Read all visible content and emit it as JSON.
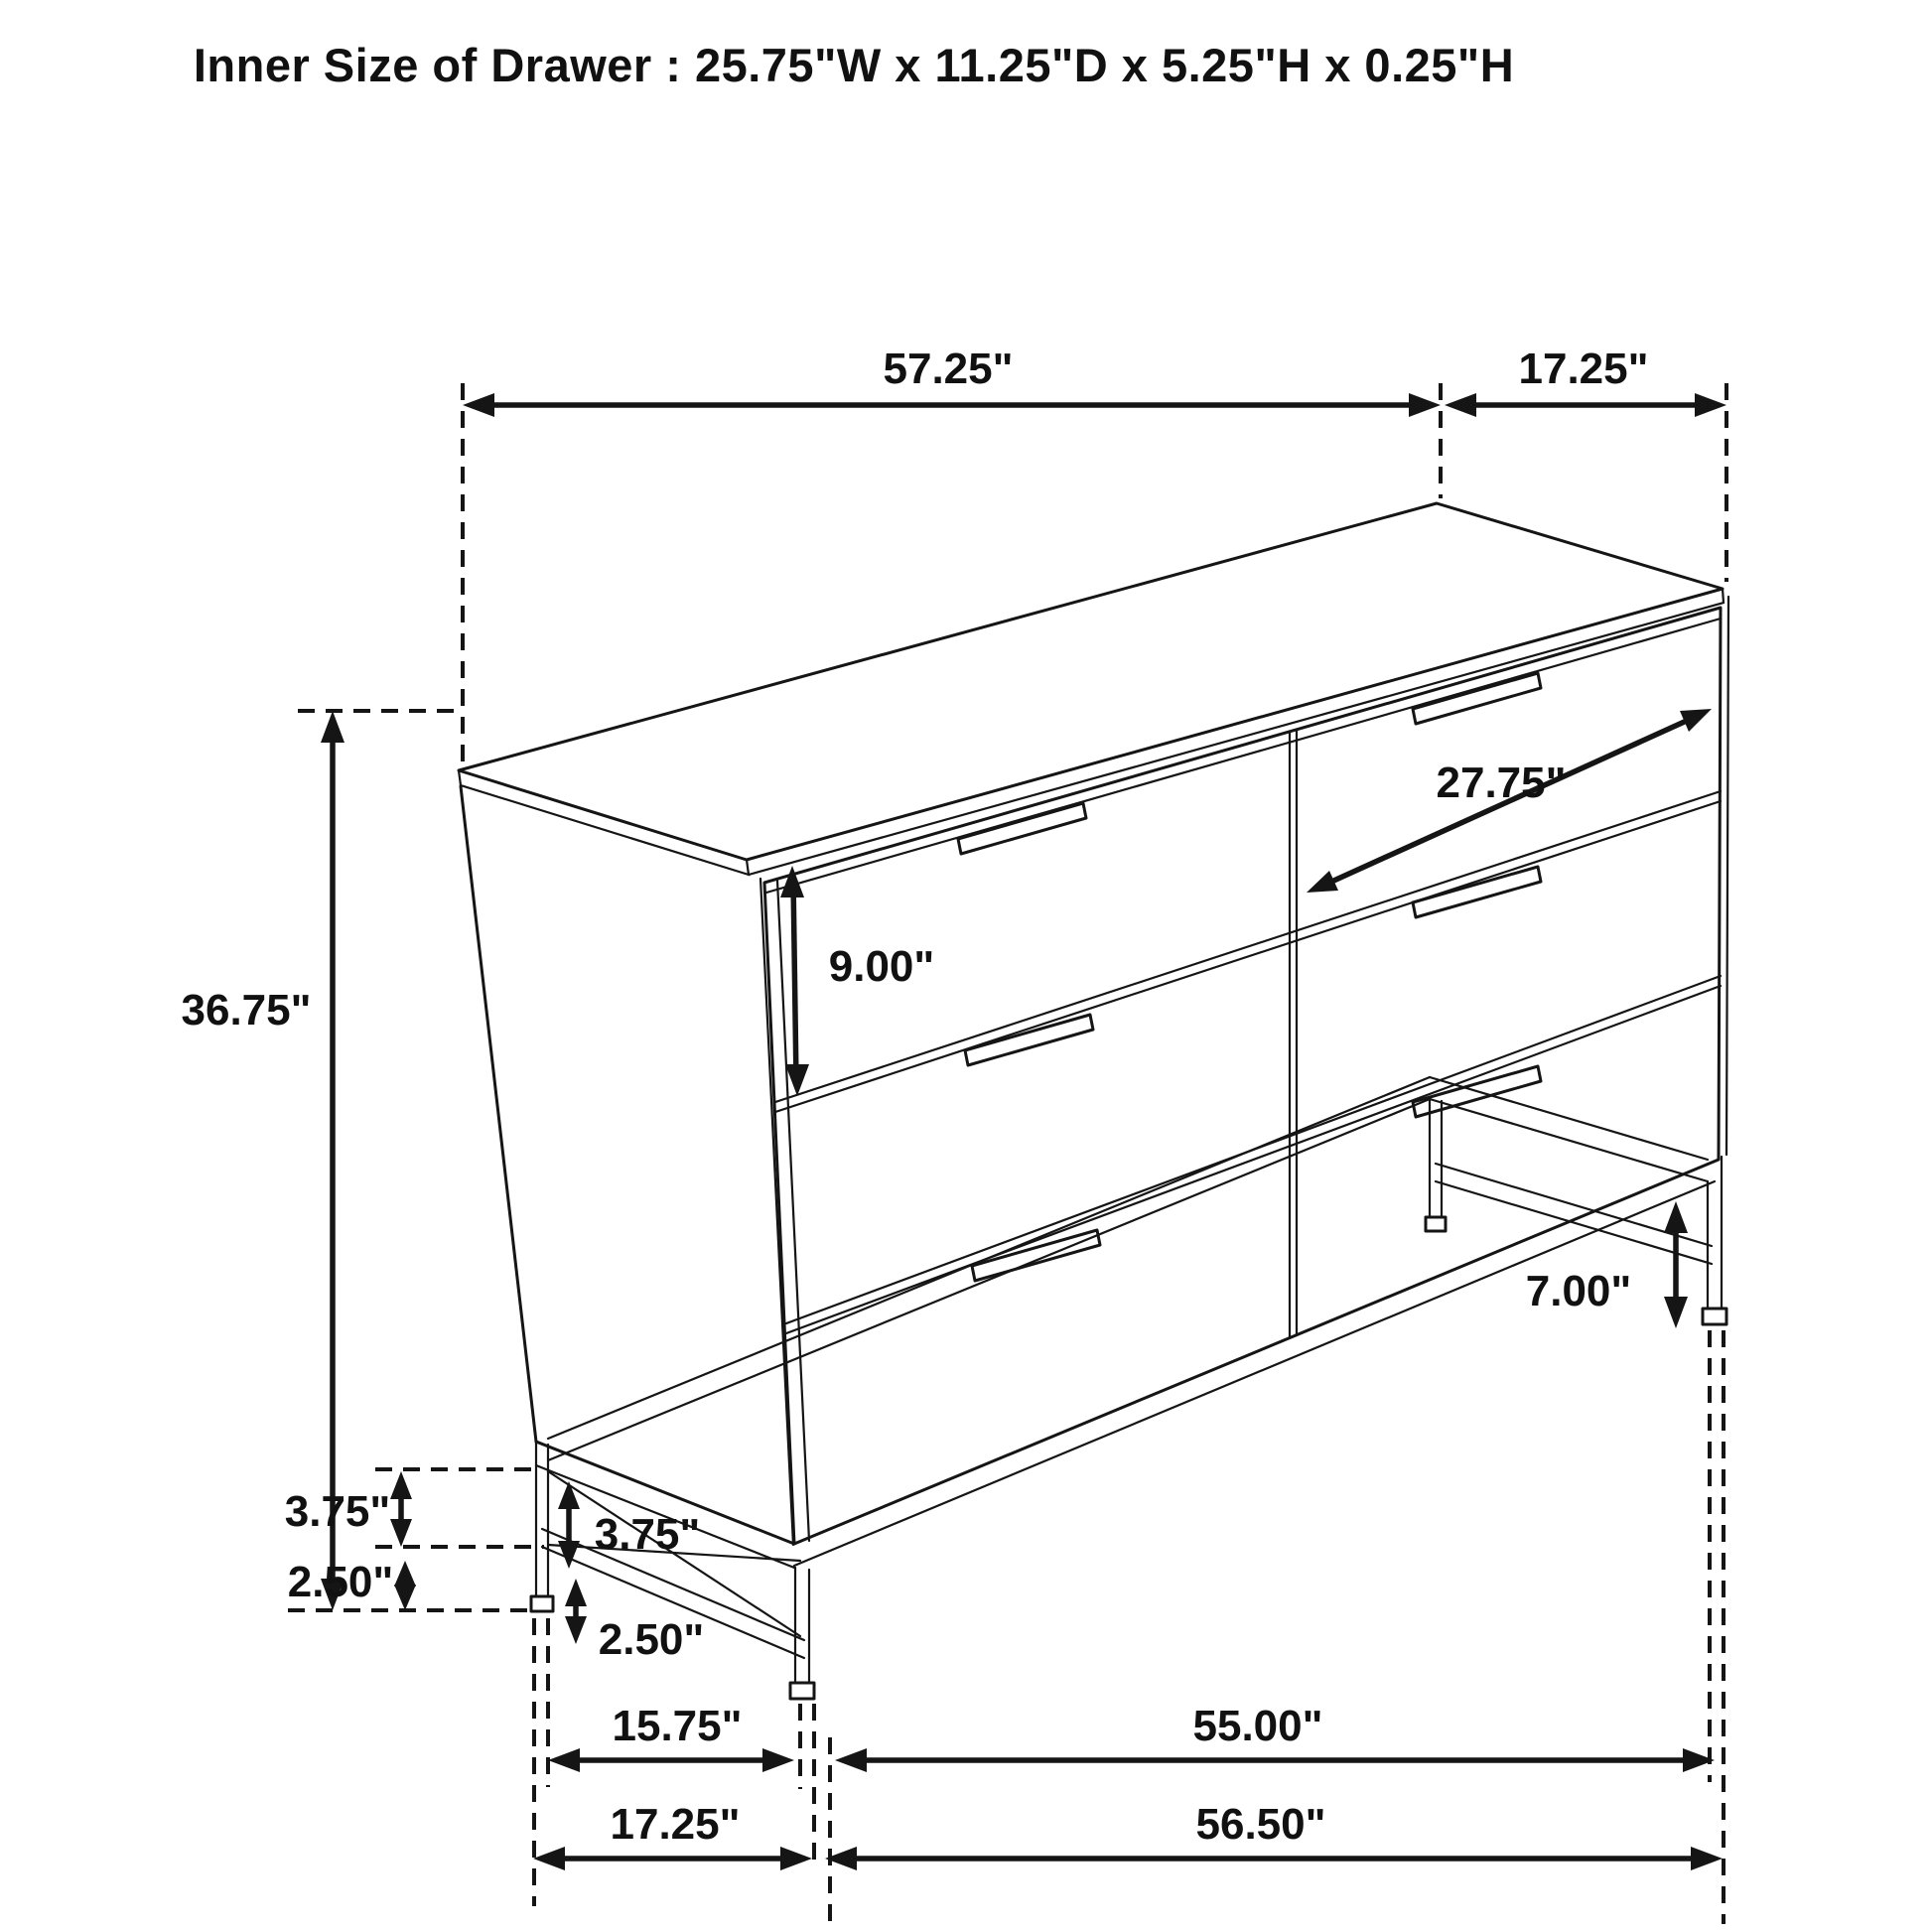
{
  "title": "Inner Size of Drawer : 25.75\"W x 11.25\"D x 5.25\"H x 0.25\"H",
  "dimensions": {
    "top_width": "57.25\"",
    "top_depth": "17.25\"",
    "overall_height": "36.75\"",
    "drawer_front_height": "9.00\"",
    "drawer_width_diagonal": "27.75\"",
    "leg_height": "7.00\"",
    "gap_upper_rear": "3.75\"",
    "gap_upper_front": "3.75\"",
    "gap_lower_rear": "2.50\"",
    "gap_lower_front": "2.50\"",
    "leg_span_depth_inner": "15.75\"",
    "leg_span_width_inner": "55.00\"",
    "leg_span_depth_outer": "17.25\"",
    "leg_span_width_outer": "56.50\""
  },
  "colors": {
    "line": "#151515",
    "background": "#ffffff"
  }
}
